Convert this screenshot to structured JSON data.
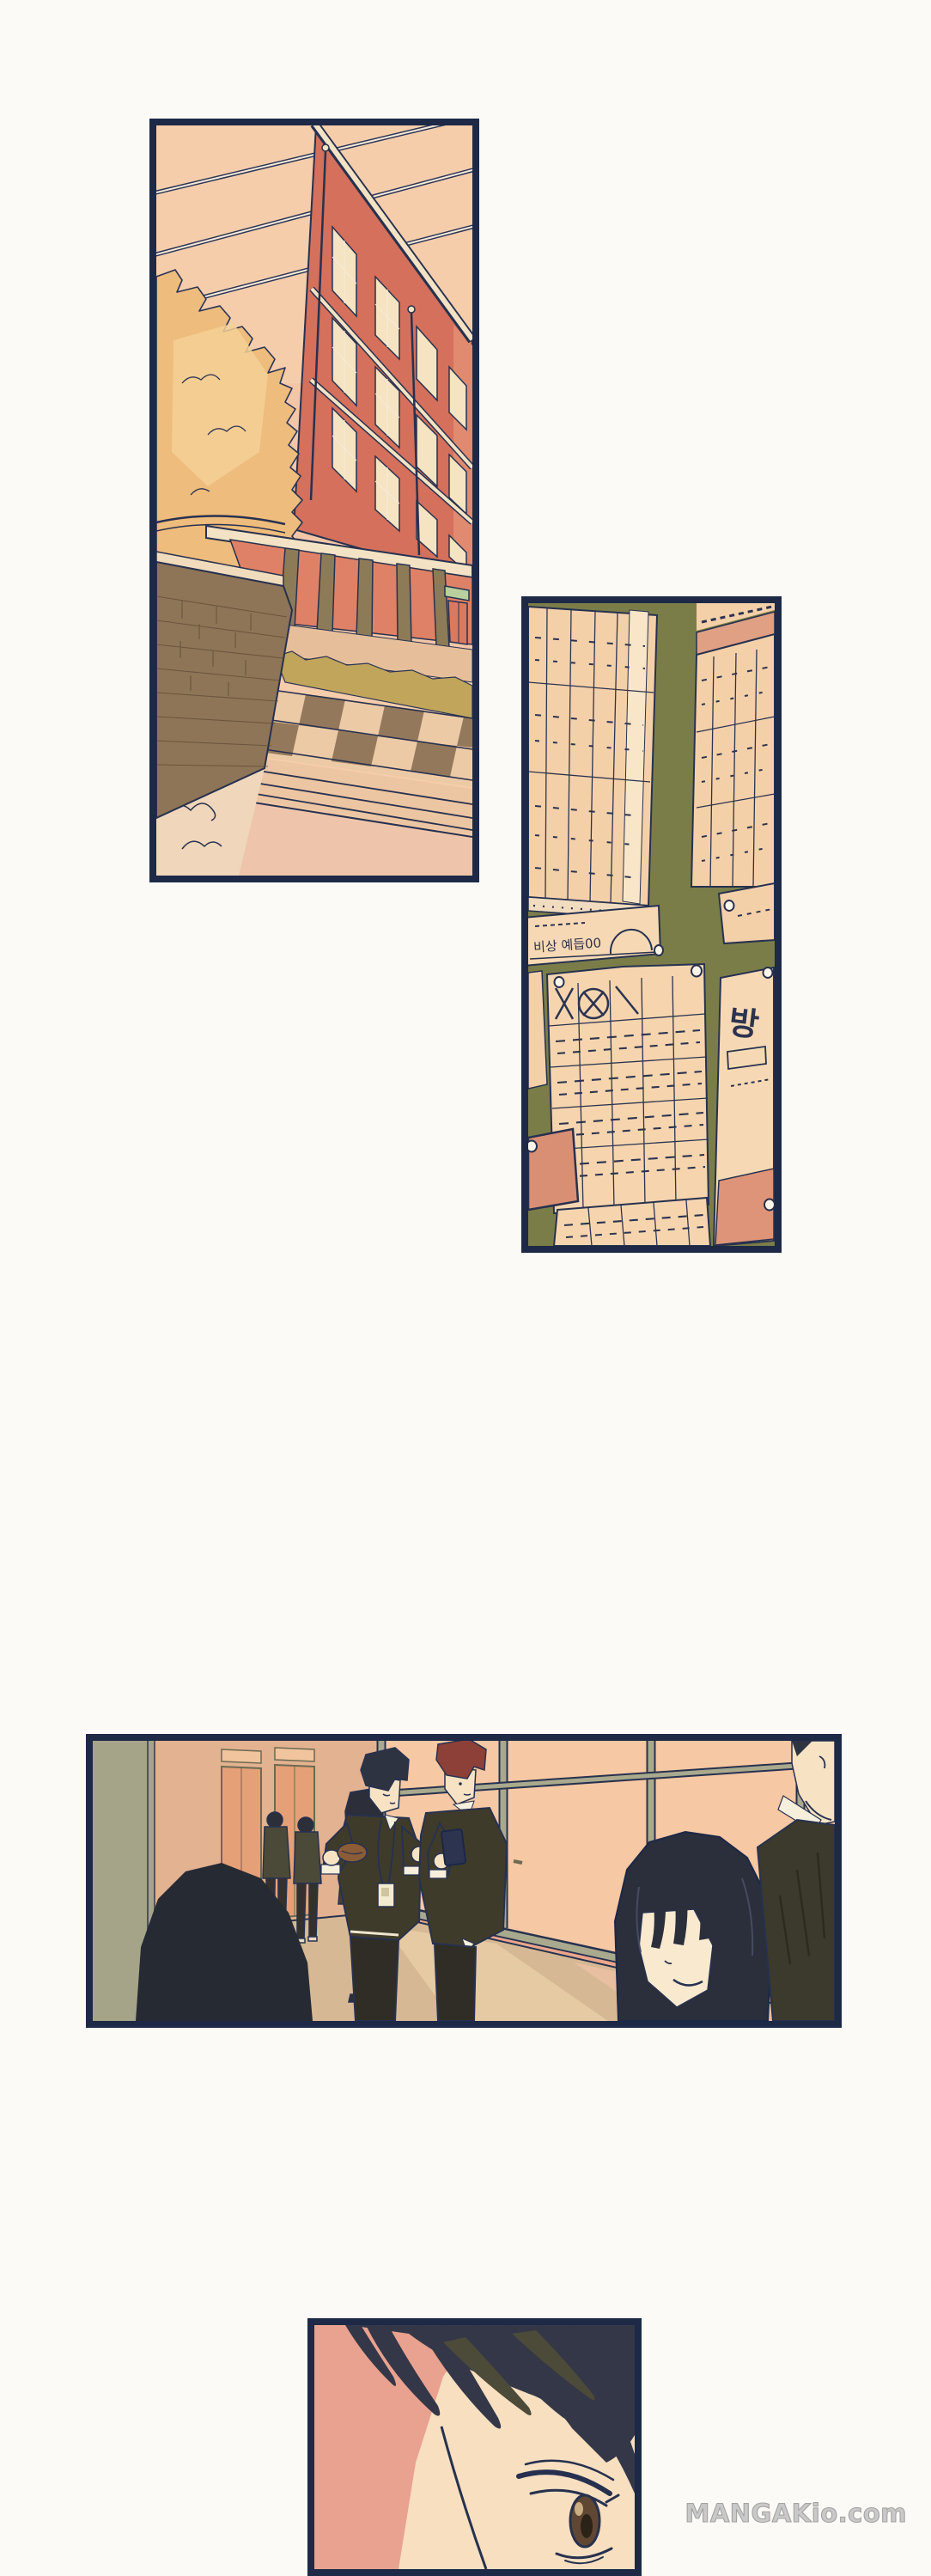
{
  "page": {
    "watermark": "MANGAKio.com",
    "background_color": "#fbfaf6",
    "panel_border_color": "#1d2946"
  },
  "panels": {
    "exterior": {
      "alt": "School building exterior with autumn tree, brick wall and checkered walkway"
    },
    "bulletin": {
      "alt": "Bulletin board covered with timetables and pinned notices",
      "notice_label": "비상 예듭00",
      "poster_char": "방"
    },
    "hallway": {
      "alt": "School hallway: students walking away, two boys looking at a phone, smiling girl in foreground"
    },
    "closeup": {
      "alt": "Close-up of a student's eye glancing sideways"
    }
  },
  "colors": {
    "outline_navy": "#27314f",
    "sky_peach": "#f5cdab",
    "building_red": "#d4705b",
    "tree_orange": "#eebc7c",
    "board_olive": "#7b7d49",
    "paper_cream": "#f4d0a9",
    "note_salmon": "#d98f74",
    "floor_tan": "#d6b894",
    "uniform_olive": "#3f3b2b",
    "watermark_gray": "#c9c9c9"
  }
}
